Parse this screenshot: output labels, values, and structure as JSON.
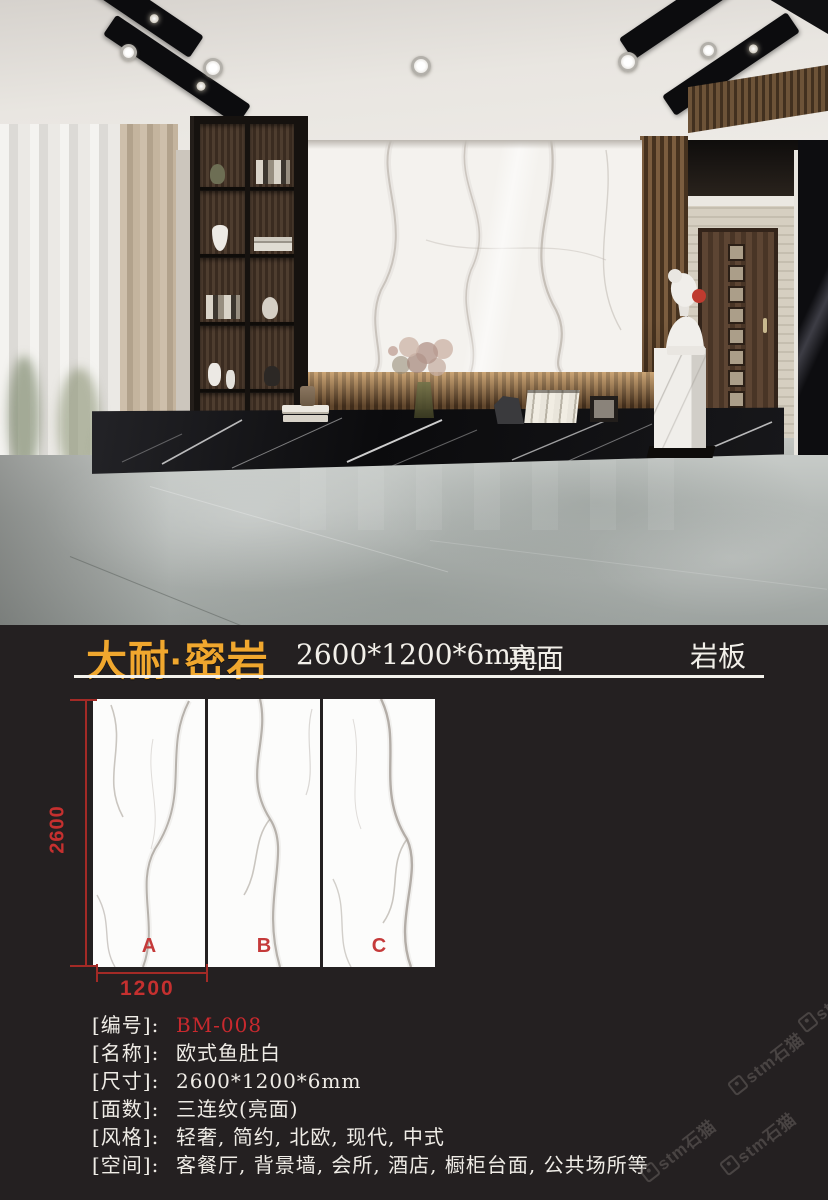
{
  "header": {
    "brand": "大耐·密岩",
    "size": "2600*1200*6mm",
    "finish": "亮面",
    "category": "岩板"
  },
  "sample": {
    "panels": [
      "A",
      "B",
      "C"
    ],
    "height_label": "2600",
    "width_label": "1200"
  },
  "specs": [
    {
      "label": "[编号]:",
      "value": "BM-008"
    },
    {
      "label": "[名称]:",
      "value": "欧式鱼肚白"
    },
    {
      "label": "[尺寸]:",
      "value": "2600*1200*6mm"
    },
    {
      "label": "[面数]:",
      "value": "三连纹(亮面)"
    },
    {
      "label": "[风格]:",
      "value": "轻奢, 简约, 北欧, 现代, 中式"
    },
    {
      "label": "[空间]:",
      "value": "客餐厅, 背景墙, 会所, 酒店, 橱柜台面, 公共场所等"
    }
  ],
  "watermark": {
    "text": "stm石猫"
  },
  "colors": {
    "gold": "#F0A72E",
    "red": "#C9292E",
    "dim_red": "#A32A26",
    "background": "#242021",
    "text": "#EFECE6"
  }
}
